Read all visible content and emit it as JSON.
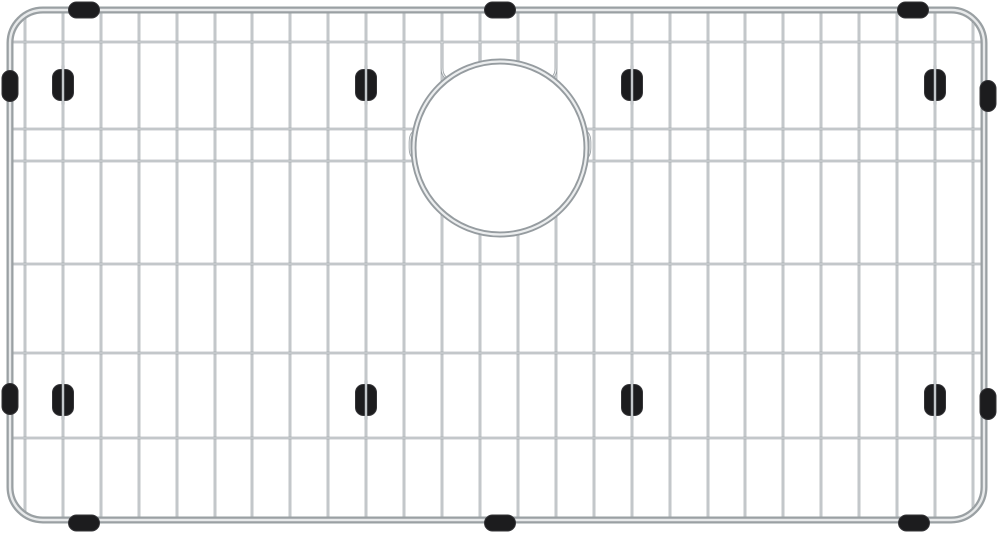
{
  "meta": {
    "alt": "Stainless steel kitchen sink bottom grid with rounded corner frame, round rear drain opening, and black rubber feet and side bumpers on a white background",
    "width": 1000,
    "height": 536
  },
  "colors": {
    "background": "#ffffff",
    "wire_base": "#989ea2",
    "wire_highlight": "#eef0f1",
    "frame_base": "#9aa0a3",
    "frame_highlight": "#e8eaeb",
    "ring_base": "#969ca0",
    "ring_highlight": "#eceeef",
    "rubber": "#1c1c1e",
    "rubber_edge": "#343437"
  },
  "frame": {
    "left": 10,
    "top": 10,
    "right": 984,
    "bottom": 520,
    "corner_radius": 33,
    "tube_width": 7,
    "highlight_width": 2.4
  },
  "grid": {
    "vertical_wire_x": [
      25,
      63,
      101,
      139,
      177,
      215,
      252,
      290,
      328,
      366,
      404,
      442,
      480,
      518,
      556,
      594,
      632,
      670,
      708,
      745,
      783,
      821,
      859,
      897,
      935,
      973
    ],
    "horizontal_wire_y": [
      42,
      129,
      161,
      264,
      353,
      438
    ],
    "wire_width": 2.6,
    "wire_highlight_width": 1.0
  },
  "drain": {
    "cx": 500,
    "cy": 148,
    "radius": 86.5,
    "ring_width": 6,
    "ring_highlight_width": 2.2,
    "top_u_connectors": [
      {
        "x1": 442,
        "x2": 480,
        "y_top": 43,
        "y_bottom": 80,
        "radius": 12
      },
      {
        "x1": 518,
        "x2": 556,
        "y_top": 43,
        "y_bottom": 80,
        "radius": 12
      }
    ],
    "side_brackets": [
      {
        "inner_x": 440,
        "outer_x": 410,
        "y1": 129,
        "y2": 161,
        "radius": 13
      },
      {
        "inner_x": 560,
        "outer_x": 590,
        "y1": 129,
        "y2": 161,
        "radius": 13
      }
    ]
  },
  "feet": {
    "column_x": [
      63,
      366,
      632,
      935
    ],
    "row_y": [
      85,
      400
    ],
    "width": 21,
    "height": 31,
    "corner_radius": 8
  },
  "bumpers": {
    "top_x": [
      84,
      500,
      913
    ],
    "top_cy": 10,
    "bottom_x": [
      84,
      500,
      914
    ],
    "bottom_cy": 523,
    "left_y": [
      86,
      399
    ],
    "left_cx": 10,
    "right_y": [
      96,
      404
    ],
    "right_cx": 988,
    "length": 31,
    "thickness": 16,
    "corner_radius": 8
  }
}
